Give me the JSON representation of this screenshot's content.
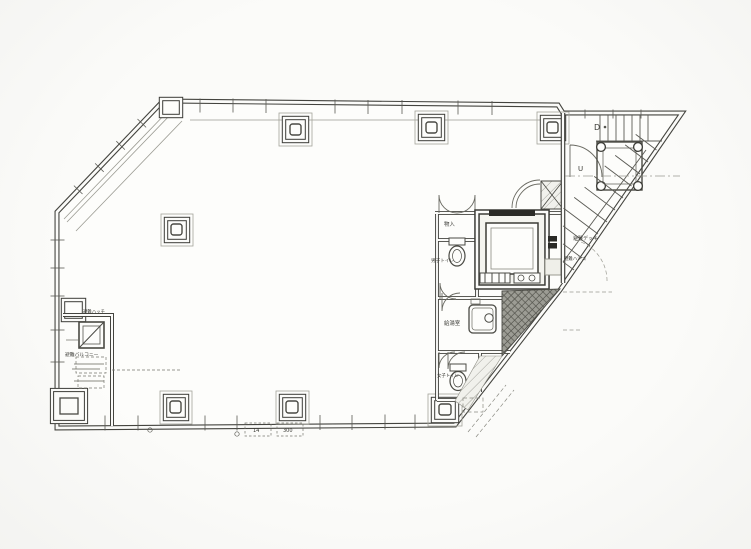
{
  "drawing": {
    "kind": "architectural-floor-plan",
    "labels": {
      "storage": "物入",
      "mens_toilet": "男子トイレ",
      "womens_toilet": "女子トイレ",
      "kitchenette": "給湯室",
      "evac_hatch": "避難ハッチ",
      "evac_balcony": "避難バルコニー",
      "evac_deck": "避難デッキ",
      "evac_ladder": "避難ハシゴ",
      "stair_down": "D",
      "stair_up": "U",
      "tag_a": "14",
      "tag_b": "300"
    },
    "colors": {
      "paper": "#fbfbf9",
      "line": "#44443f",
      "light_line": "#8f8f88",
      "dark_fill": "#2a2a26",
      "hatch_fill": "#a3a39c"
    }
  }
}
